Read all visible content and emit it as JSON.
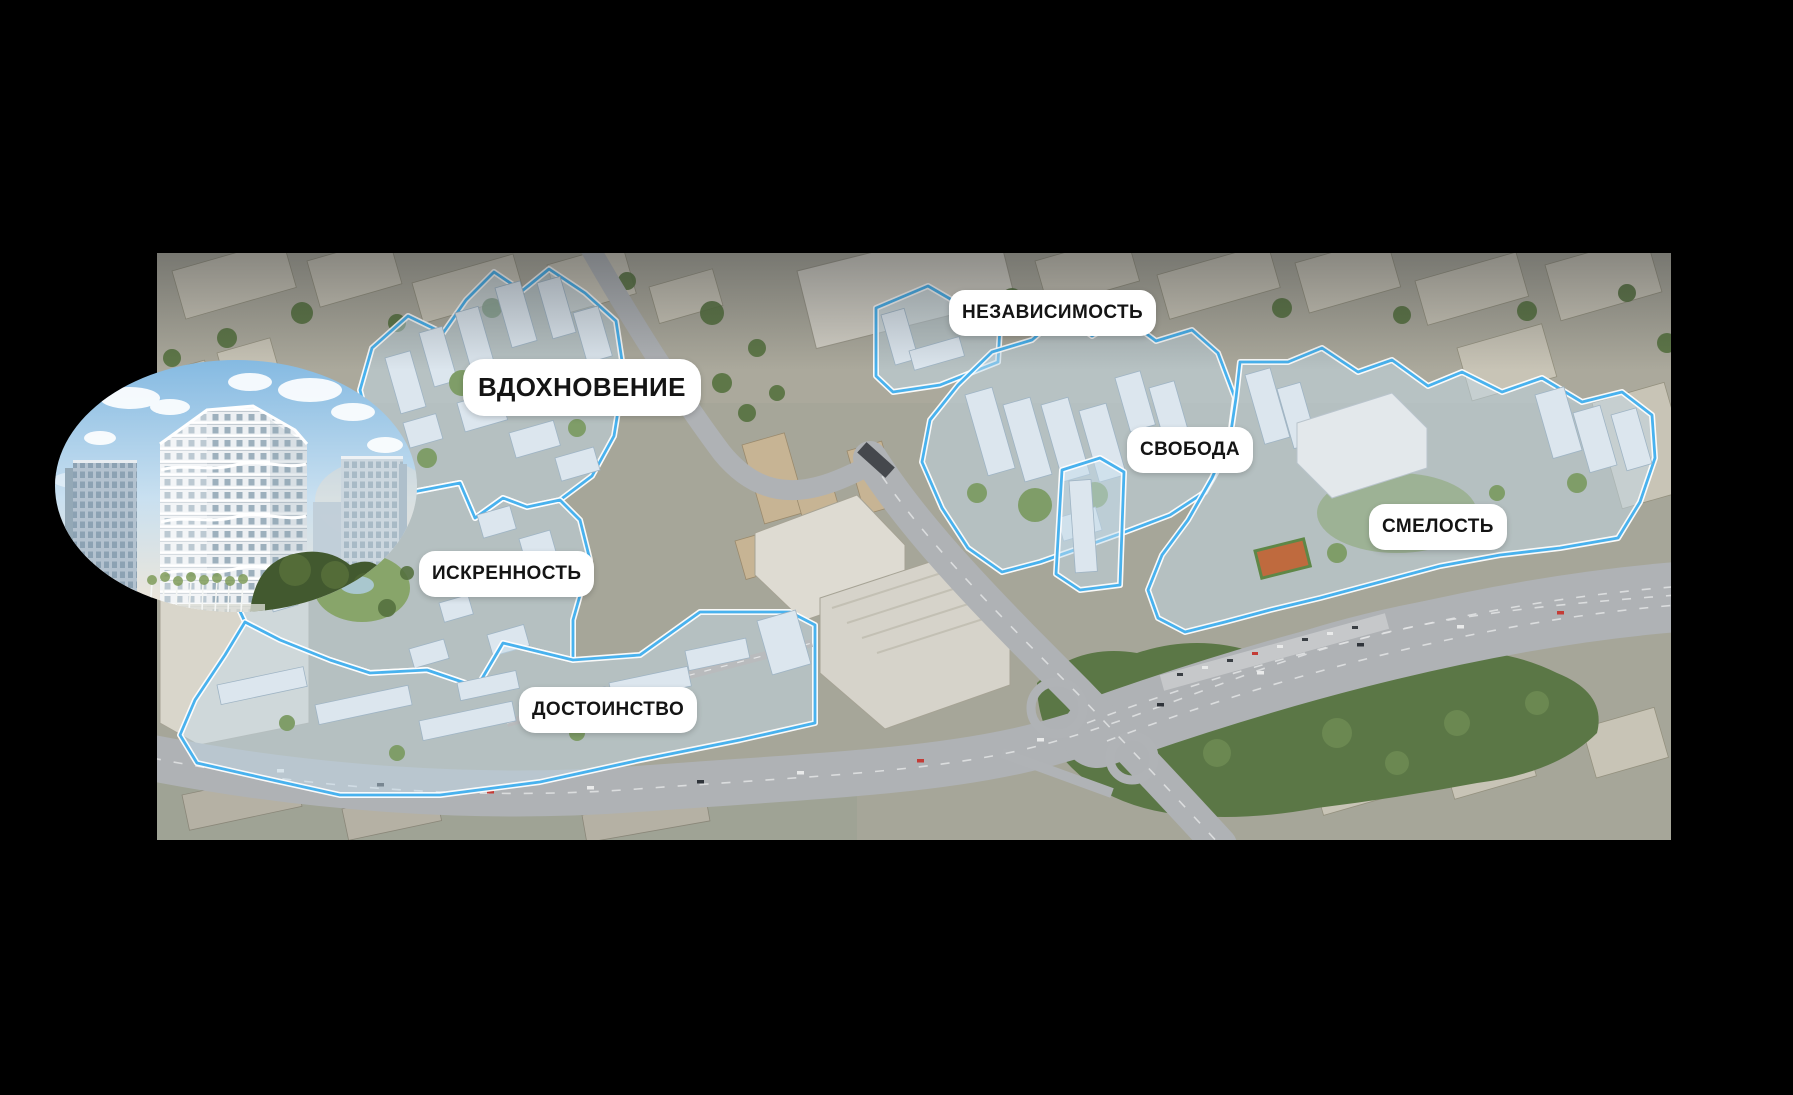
{
  "scene": {
    "background": "#000000"
  },
  "map": {
    "outline_color": "#49b2ee",
    "label_background": "#ffffff",
    "label_text_color": "#141414",
    "districts": [
      {
        "id": "vdokhnovenie",
        "label": "ВДОХНОВЕНИЕ"
      },
      {
        "id": "nezavisimost",
        "label": "НЕЗАВИСИМОСТЬ"
      },
      {
        "id": "svoboda",
        "label": "СВОБОДА"
      },
      {
        "id": "smelost",
        "label": "СМЕЛОСТЬ"
      },
      {
        "id": "iskrennost",
        "label": "ИСКРЕННОСТЬ"
      },
      {
        "id": "dostoinstvo",
        "label": "ДОСТОИНСТВО"
      }
    ]
  }
}
